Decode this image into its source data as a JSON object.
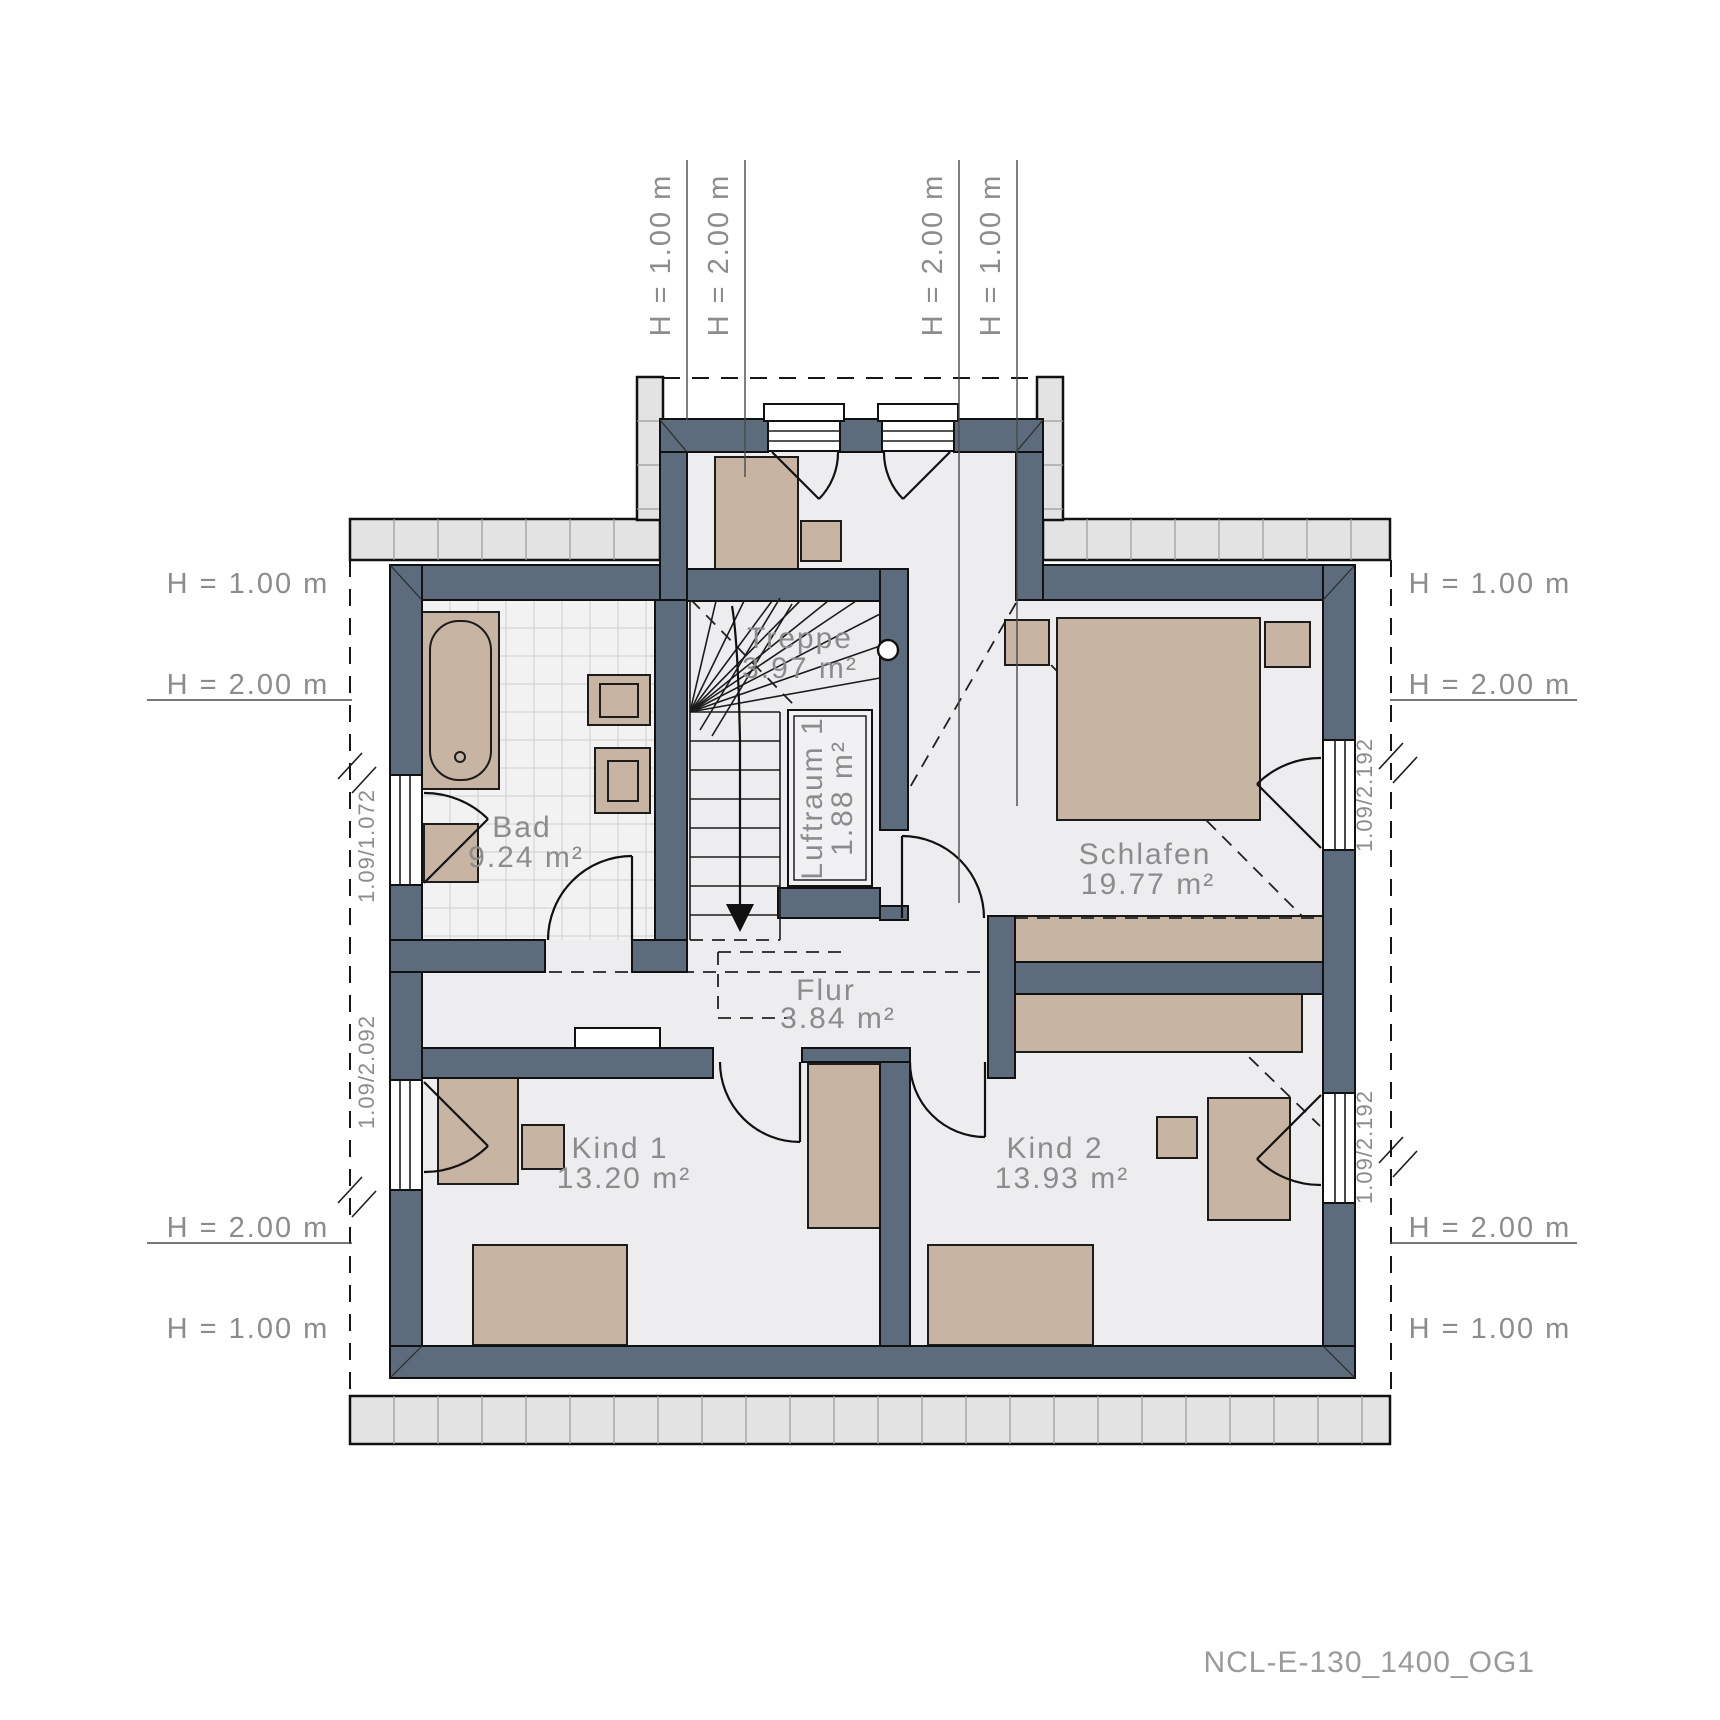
{
  "plan": {
    "footer": "NCL-E-130_1400_OG1",
    "rooms": [
      {
        "name": "Treppe",
        "area": "3.97 m²"
      },
      {
        "name": "Luftraum 1",
        "area": "1.88 m²"
      },
      {
        "name": "Bad",
        "area": "9.24 m²"
      },
      {
        "name": "Schlafen",
        "area": "19.77 m²"
      },
      {
        "name": "Flur",
        "area": "3.84 m²"
      },
      {
        "name": "Kind 1",
        "area": "13.20 m²"
      },
      {
        "name": "Kind 2",
        "area": "13.93 m²"
      }
    ],
    "height_markers": {
      "top": [
        "H = 1.00 m",
        "H = 2.00 m",
        "H = 2.00 m",
        "H = 1.00 m"
      ],
      "left": [
        "H = 1.00 m",
        "H = 2.00 m",
        "H = 2.00 m",
        "H = 1.00 m"
      ],
      "right": [
        "H = 1.00 m",
        "H = 2.00 m",
        "H = 2.00 m",
        "H = 1.00 m"
      ]
    },
    "window_dimensions": [
      "1.09/1.072",
      "1.09/2.092",
      "1.09/2.192",
      "1.09/2.192"
    ],
    "colors": {
      "wall": "#5c6c7d",
      "furniture": "#c7b4a2",
      "floor": "#ededef",
      "label": "#8c8c8c"
    }
  }
}
